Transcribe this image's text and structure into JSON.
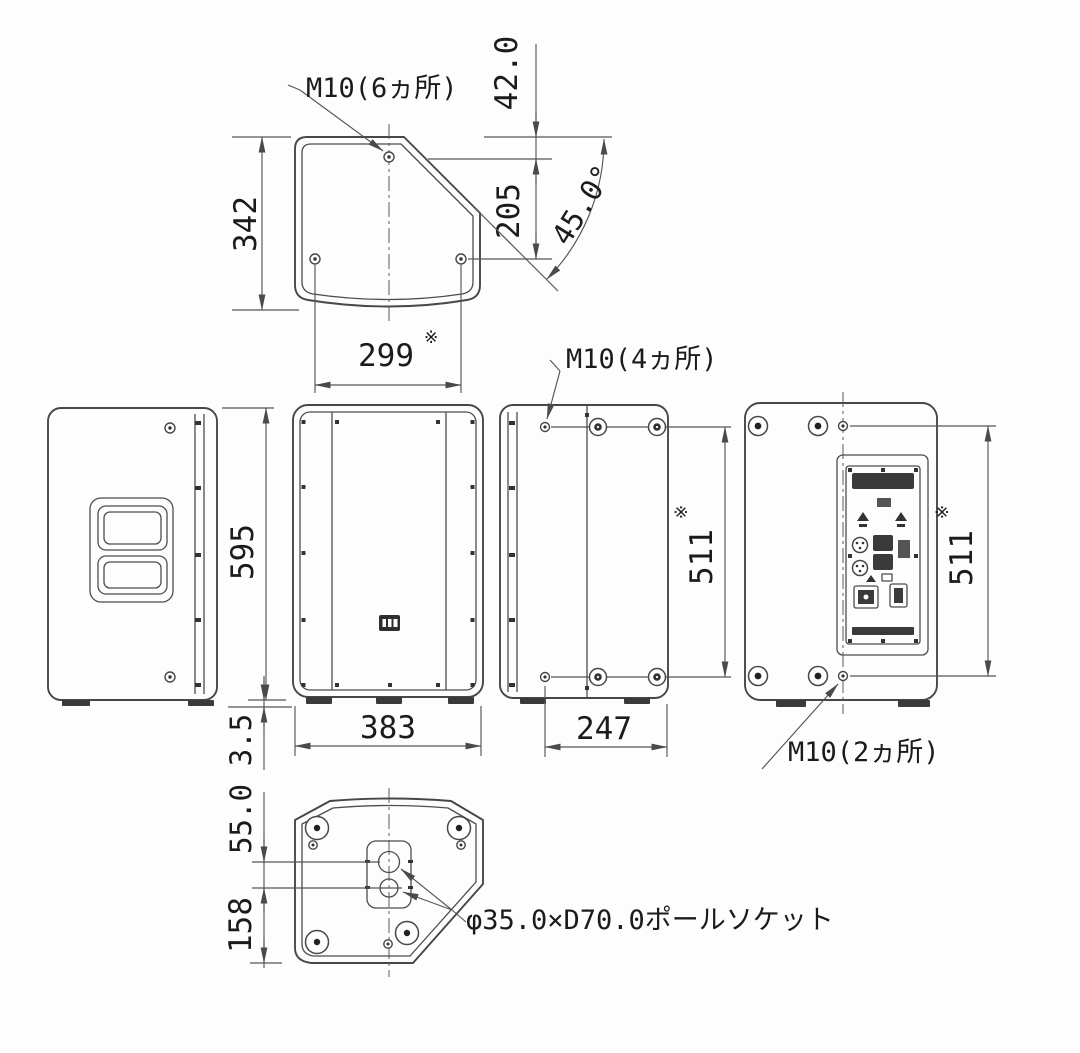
{
  "annotations": {
    "m10_6": "M10(6ヵ所)",
    "m10_4": "M10(4ヵ所)",
    "m10_2": "M10(2ヵ所)",
    "pole_socket": "φ35.0×D70.0ポールソケット",
    "reference_mark": "※"
  },
  "dimensions": {
    "top_depth": "342",
    "back_offset": "42.0",
    "screw_offset": "205",
    "baffle_angle": "45.0°",
    "top_screw_span": "299",
    "cabinet_height": "595",
    "foot_height": "3.5",
    "cabinet_width": "383",
    "side_screw_span": "247",
    "side_screw_height": "511",
    "rear_screw_height": "511",
    "socket_hole_gap": "55.0",
    "socket_to_edge": "158"
  }
}
